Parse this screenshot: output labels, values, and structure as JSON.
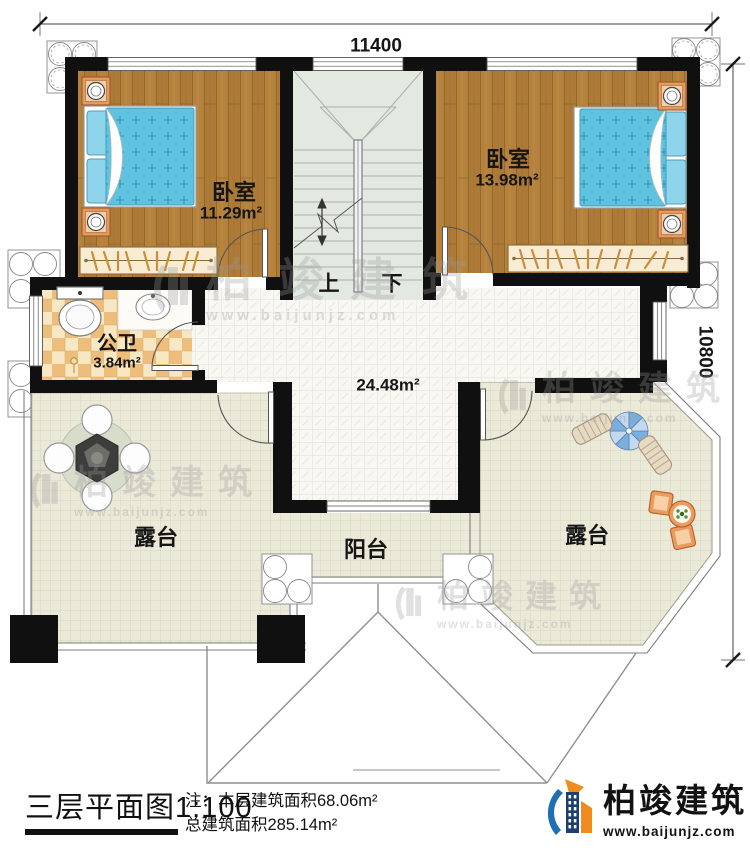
{
  "dimensions": {
    "top": "11400",
    "right": "10800"
  },
  "rooms": {
    "bedroom_left": {
      "label": "卧室",
      "area": "11.29m²"
    },
    "bedroom_right": {
      "label": "卧室",
      "area": "13.98m²"
    },
    "bathroom": {
      "label": "公卫",
      "area": "3.84m²"
    },
    "hall": {
      "area": "24.48m²"
    },
    "terrace_left": {
      "label": "露台"
    },
    "terrace_right": {
      "label": "露台"
    },
    "balcony": {
      "label": "阳台"
    }
  },
  "stairs": {
    "up": "上",
    "down": "下"
  },
  "watermark": {
    "brand": "柏竣建筑",
    "url": "www.baijunjz.com"
  },
  "title_block": {
    "title": "三层平面图1:100",
    "note_line1": "注：本层建筑面积68.06m²",
    "note_line2": "总建筑面积285.14m²"
  },
  "logo": {
    "brand": "柏竣建筑",
    "url": "www.baijunjz.com"
  },
  "colors": {
    "wall": "#101010",
    "wood_floor": "#b5823e",
    "terrace_floor": "#ebe9d8",
    "checker": "#edbd7b",
    "quilt_blue": "#5fc3e0",
    "stair_floor": "#e3e8e1",
    "logo_orange": "#f08c1e",
    "logo_blue": "#1f6fb5"
  }
}
